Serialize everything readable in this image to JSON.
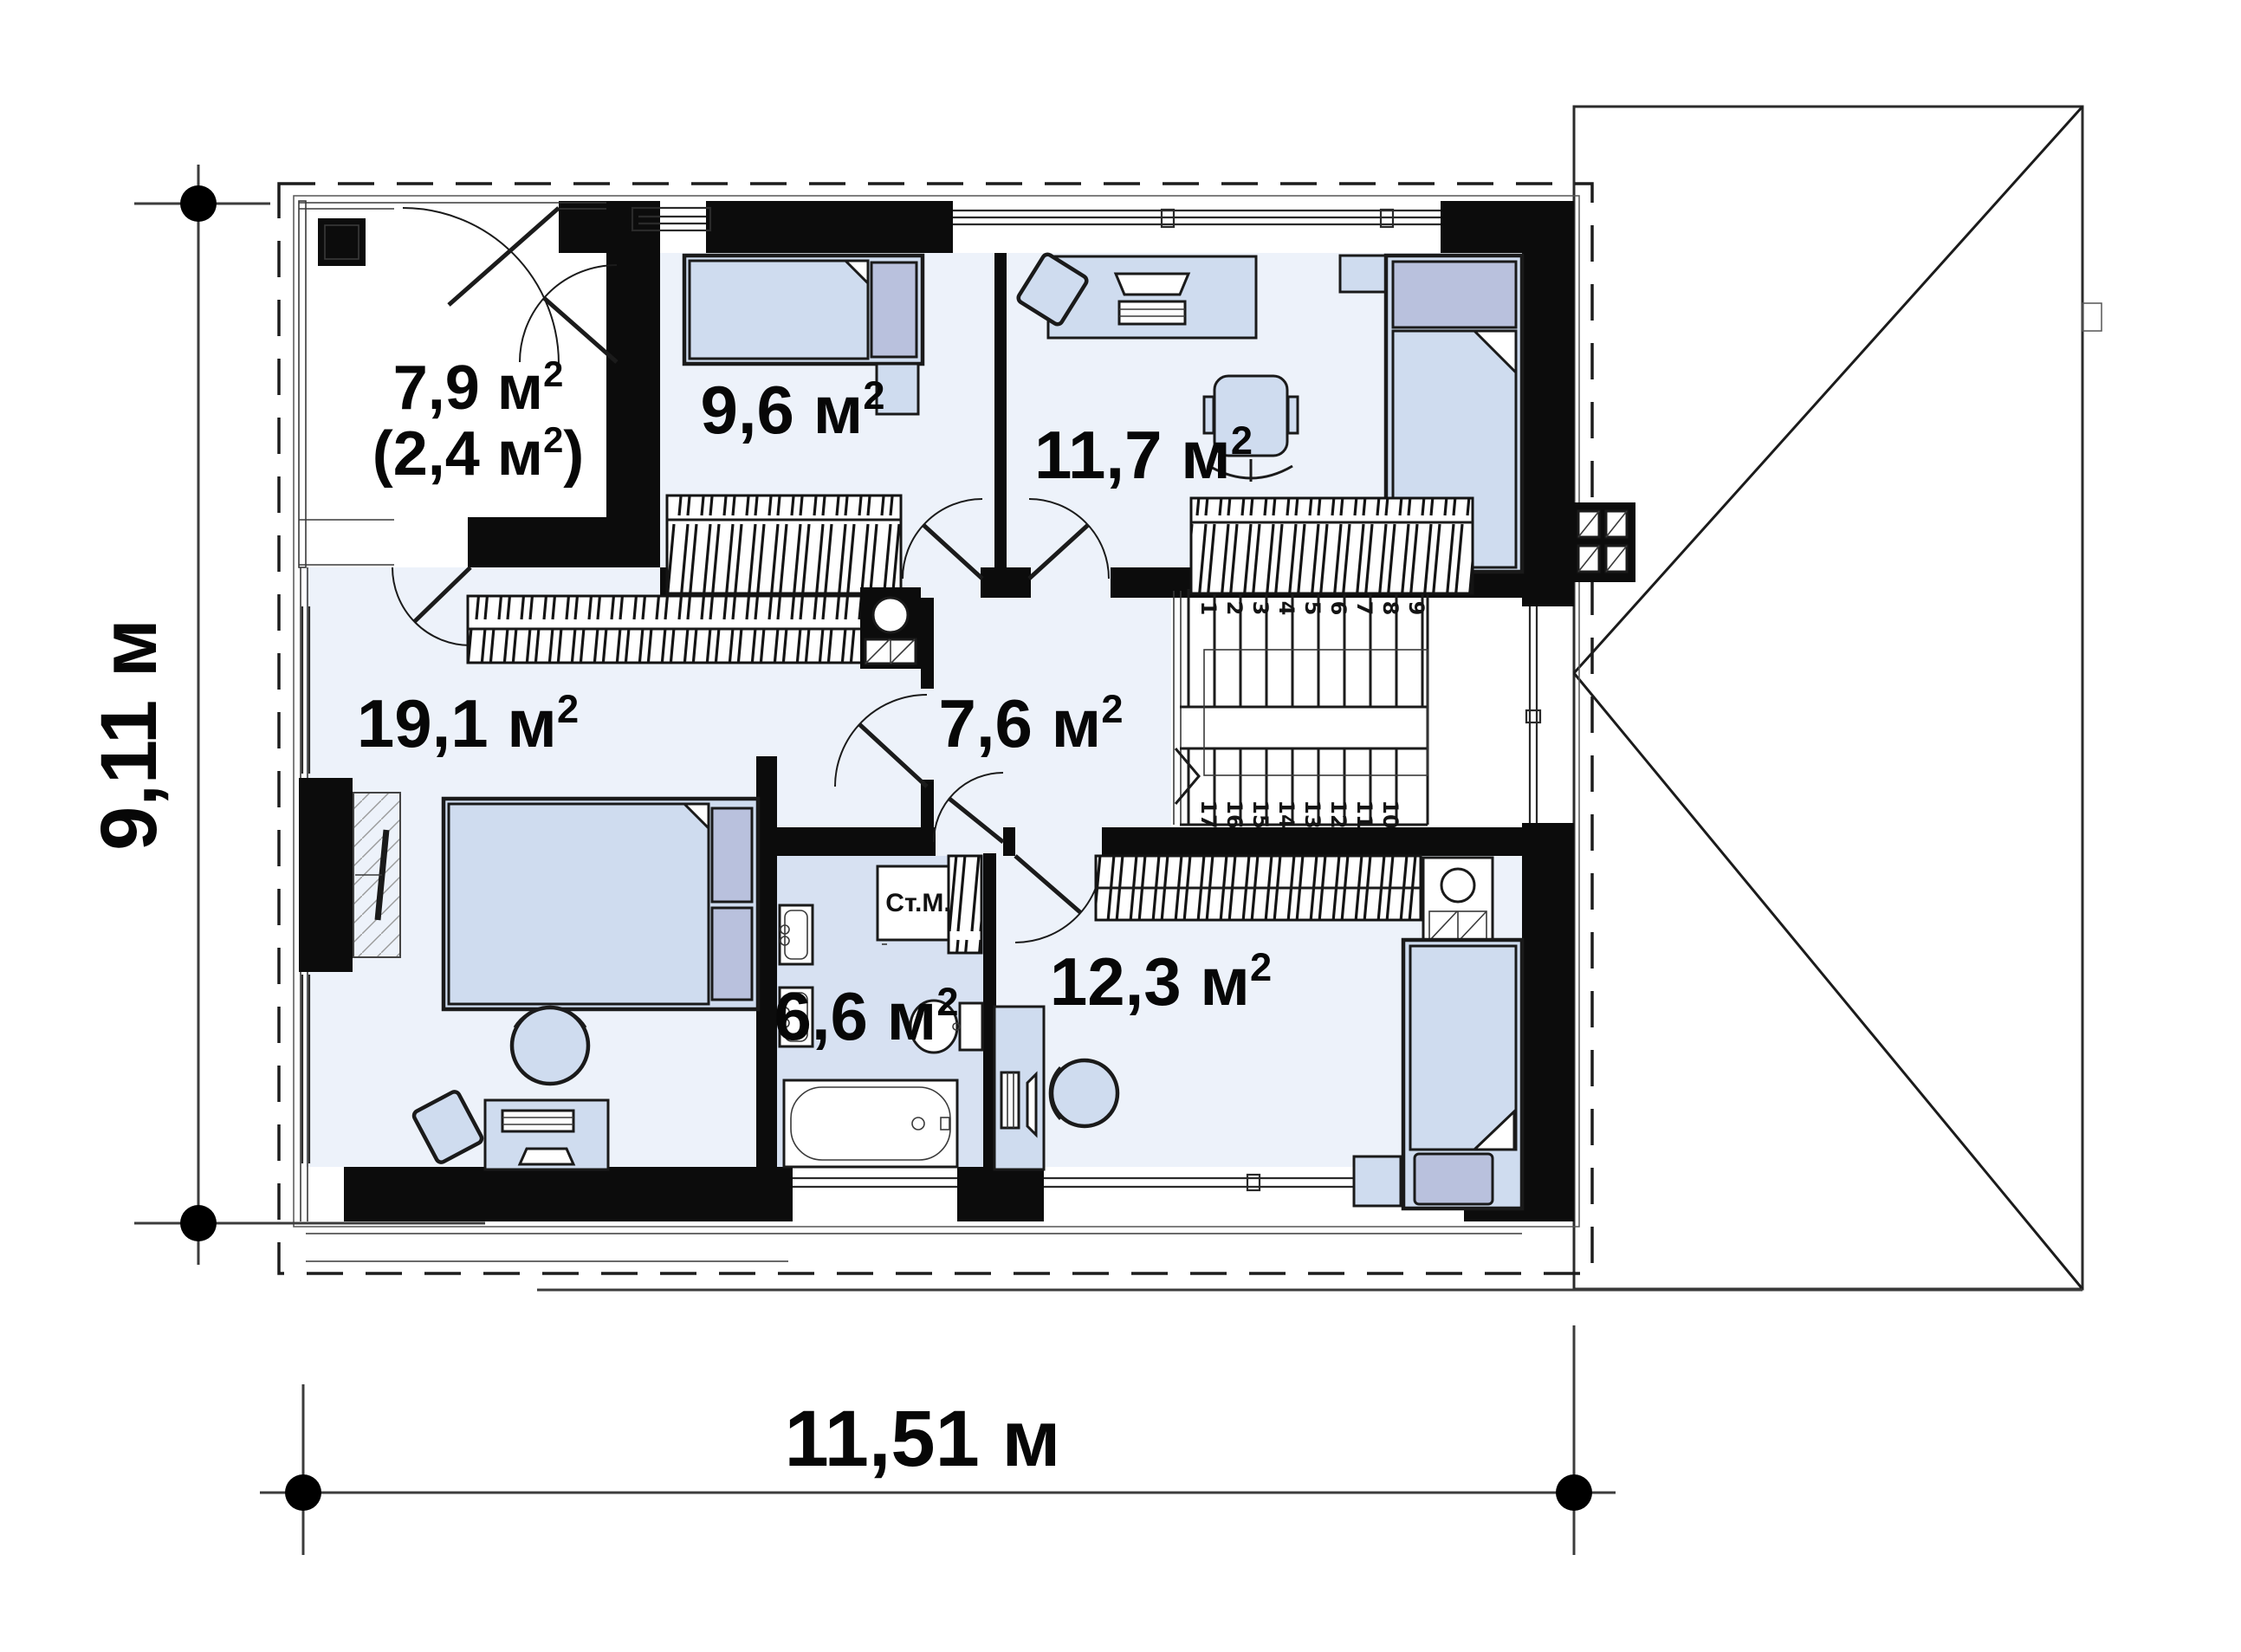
{
  "plan": {
    "type": "architectural-floor-plan",
    "floor": "second floor",
    "colors": {
      "wall": "#0c0c0c",
      "floor": "#edf2fa",
      "bathfloor": "#d7e1f2",
      "furn": "#cfdcef",
      "accent": "#b9c1dd",
      "line": "#1a1a1a"
    },
    "rooms": [
      {
        "id": "storage",
        "label_pre": "7,9 м",
        "label_sup": "2",
        "label2_pre": "(2,4 м",
        "label2_sup": "2",
        "label2_post": ")"
      },
      {
        "id": "bedroom-1",
        "label_pre": "9,6 м",
        "label_sup": "2"
      },
      {
        "id": "bedroom-2",
        "label_pre": "11,7 м",
        "label_sup": "2"
      },
      {
        "id": "master-bedroom",
        "label_pre": "19,1 м",
        "label_sup": "2"
      },
      {
        "id": "hallway",
        "label_pre": "7,6 м",
        "label_sup": "2"
      },
      {
        "id": "bathroom",
        "label_pre": "6,6 м",
        "label_sup": "2"
      },
      {
        "id": "bedroom-3",
        "label_pre": "12,3 м",
        "label_sup": "2"
      }
    ],
    "labels": {
      "washing_machine": "Ст.М."
    },
    "dimensions": {
      "width": "11,51 м",
      "height": "9,11 м"
    },
    "stairs": {
      "up": [
        "1",
        "2",
        "3",
        "4",
        "5",
        "6",
        "7",
        "8",
        "9"
      ],
      "down": [
        "17",
        "16",
        "15",
        "14",
        "13",
        "12",
        "11",
        "10"
      ]
    }
  }
}
